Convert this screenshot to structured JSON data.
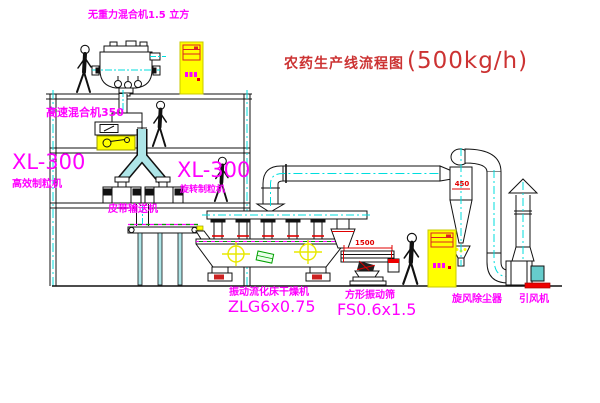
{
  "title": {
    "name": "农药生产线流程图",
    "capacity": "(500kg/h)"
  },
  "equipment_labels": {
    "zero_gravity_mixer": "无重力混合机1.5 立方",
    "high_speed_mixer": "高速混合机350",
    "granulator_left": {
      "model": "XL-300",
      "name": "高效制粒机"
    },
    "granulator_right": {
      "model": "XL-300",
      "name": "旋转制粒机"
    },
    "belt_conveyor": "皮带输送机",
    "fluid_bed_dryer": {
      "name": "振动流化床干燥机",
      "model": "ZLG6x0.75"
    },
    "vibrating_sieve": {
      "name": "方形振动筛",
      "model": "FS0.6x1.5"
    },
    "cyclone": "旋风除尘器",
    "induced_draft_fan": "引风机"
  },
  "dimensions": {
    "cyclone_width": "450",
    "sieve_length": "1500"
  },
  "colors": {
    "label_magenta": "#ff00ff",
    "title_red": "#cc3333",
    "centerline_cyan": "#00dede",
    "chute_cyan_fill": "#aee6e8",
    "cabinet_yellow": "#ffff00",
    "accent_green": "#00a000",
    "accent_red": "#e00000"
  }
}
